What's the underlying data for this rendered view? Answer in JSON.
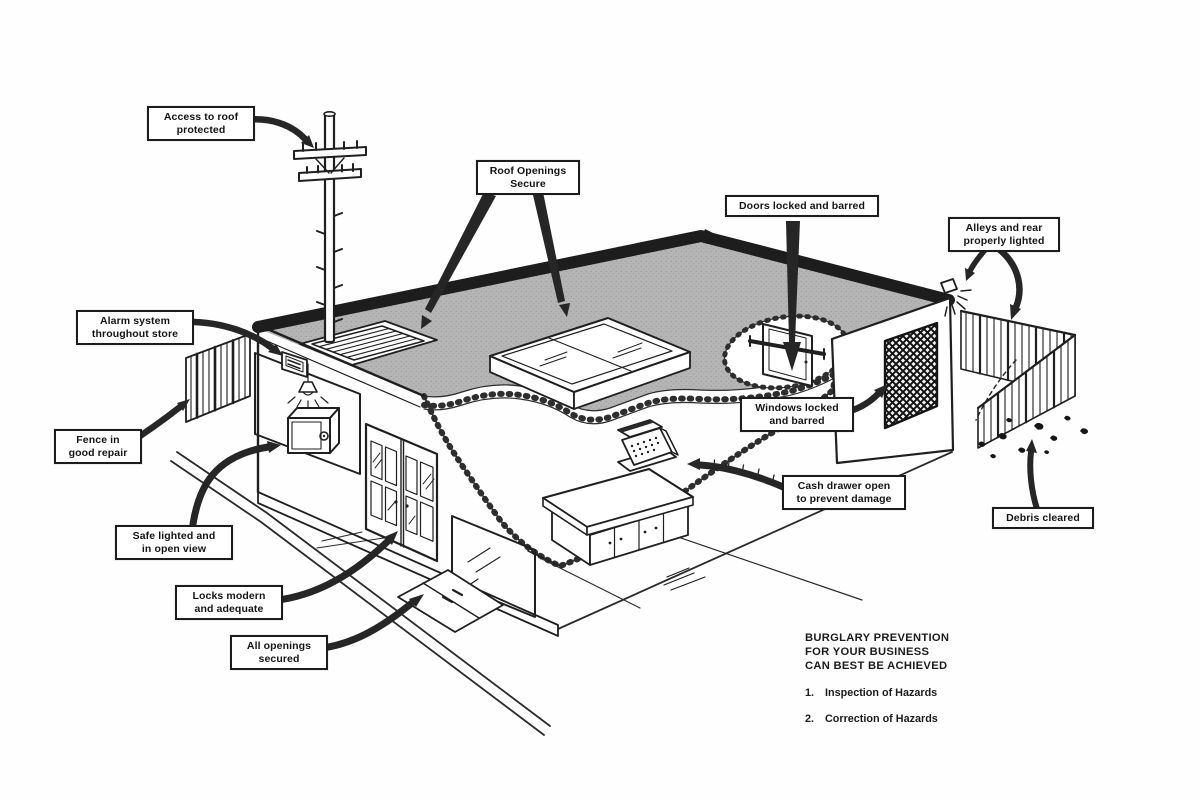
{
  "callouts": [
    {
      "id": "access-to-roof-protected",
      "lines": [
        "Access to roof",
        "protected"
      ]
    },
    {
      "id": "roof-openings-secure",
      "lines": [
        "Roof Openings",
        "Secure"
      ]
    },
    {
      "id": "doors-locked-and-barred",
      "lines": [
        "Doors locked and barred"
      ]
    },
    {
      "id": "alleys-and-rear-properly-lighted",
      "lines": [
        "Alleys and rear",
        "properly lighted"
      ]
    },
    {
      "id": "alarm-system-throughout-store",
      "lines": [
        "Alarm system",
        "throughout store"
      ]
    },
    {
      "id": "fence-in-good-repair",
      "lines": [
        "Fence in",
        "good repair"
      ]
    },
    {
      "id": "windows-locked-and-barred",
      "lines": [
        "Windows locked",
        "and barred"
      ]
    },
    {
      "id": "safe-lighted-and-in-open-view",
      "lines": [
        "Safe lighted and",
        "in open view"
      ]
    },
    {
      "id": "cash-drawer-open-to-prevent-damage",
      "lines": [
        "Cash drawer open",
        "to prevent damage"
      ]
    },
    {
      "id": "locks-modern-and-adequate",
      "lines": [
        "Locks modern",
        "and adequate"
      ]
    },
    {
      "id": "all-openings-secured",
      "lines": [
        "All openings",
        "secured"
      ]
    },
    {
      "id": "debris-cleared",
      "lines": [
        "Debris cleared"
      ]
    }
  ],
  "footer": {
    "heading_lines": [
      "BURGLARY PREVENTION",
      "FOR YOUR BUSINESS",
      "CAN BEST BE ACHIEVED"
    ],
    "items": [
      {
        "num": "1.",
        "text": "Inspection of Hazards"
      },
      {
        "num": "2.",
        "text": "Correction of Hazards"
      }
    ]
  },
  "colors": {
    "ink": "#1f1f1f",
    "roof_gray": "#b5b5b5",
    "arrow": "#262626",
    "paper": "#ffffff"
  }
}
